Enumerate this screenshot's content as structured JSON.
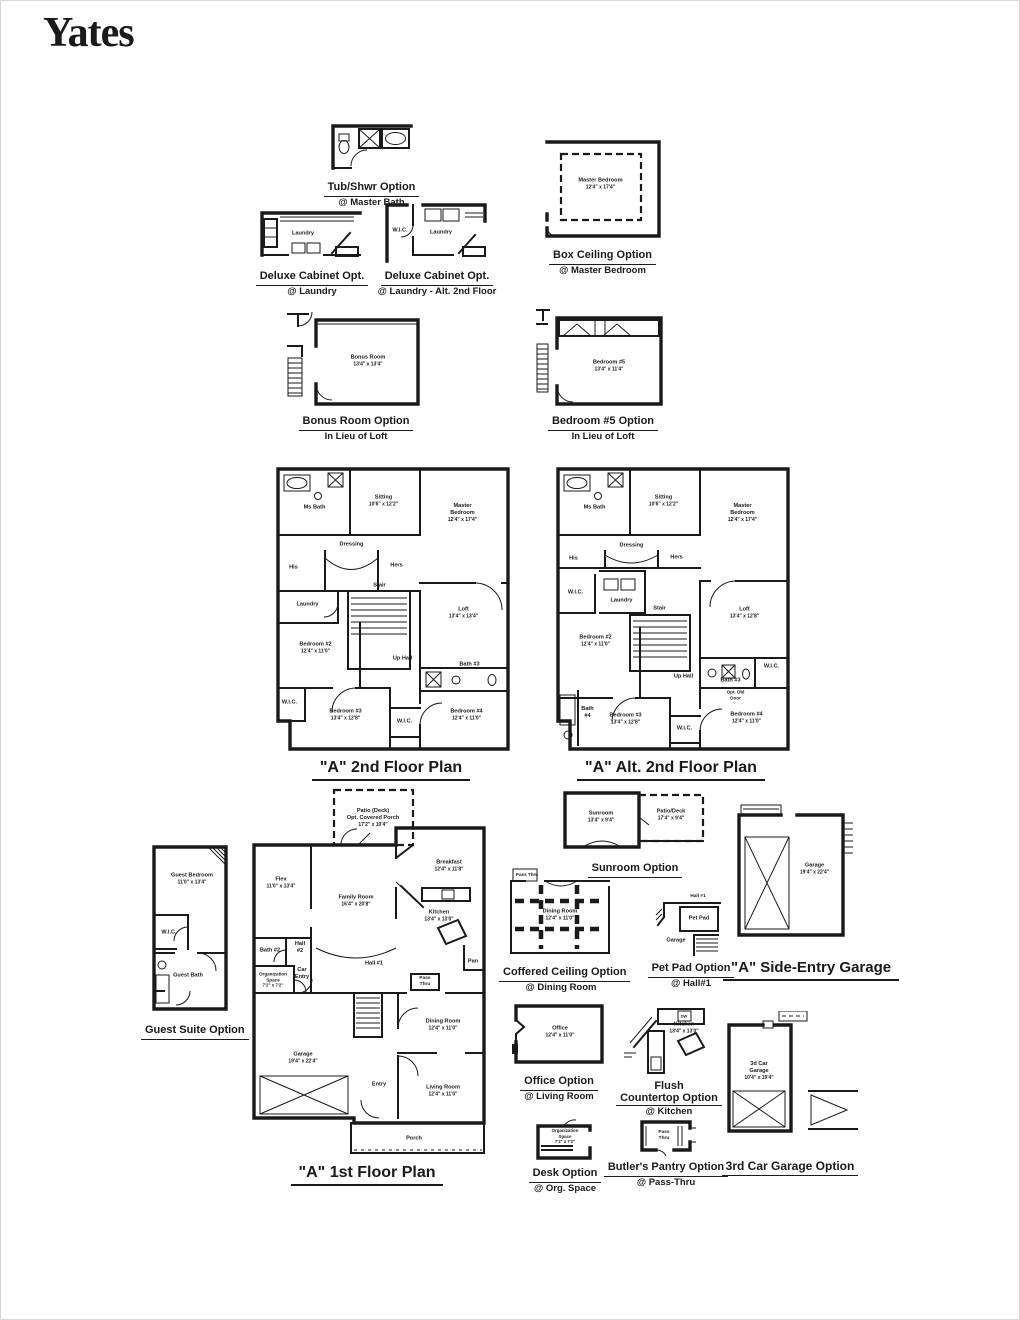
{
  "page": {
    "title": "Yates"
  },
  "options": {
    "tub_shwr": {
      "title": "Tub/Shwr Option",
      "subtitle": "@ Master Bath"
    },
    "deluxe1": {
      "title": "Deluxe Cabinet Opt.",
      "subtitle": "@ Laundry",
      "rooms": {
        "laundry": {
          "name": "Laundry"
        }
      }
    },
    "deluxe2": {
      "title": "Deluxe Cabinet Opt.",
      "subtitle": "@ Laundry - Alt. 2nd Floor",
      "rooms": {
        "laundry": {
          "name": "Laundry"
        },
        "wic": {
          "name": "W.I.C."
        }
      }
    },
    "box_ceiling": {
      "title": "Box Ceiling Option",
      "subtitle": "@ Master Bedroom",
      "rooms": {
        "master": {
          "name": "Master Bedroom",
          "dims": "12'4\" x 17'4\""
        }
      }
    },
    "bonus": {
      "title": "Bonus Room Option",
      "subtitle": "In Lieu of Loft",
      "rooms": {
        "bonus": {
          "name": "Bonus Room",
          "dims": "13'4\" x 13'4\""
        }
      }
    },
    "bedroom5": {
      "title": "Bedroom #5 Option",
      "subtitle": "In Lieu of Loft",
      "rooms": {
        "bed5": {
          "name": "Bedroom #5",
          "dims": "13'4\" x 11'4\""
        }
      }
    },
    "guest": {
      "title": "Guest Suite Option",
      "rooms": {
        "bedroom": {
          "name": "Guest Bedroom",
          "dims": "11'0\" x 13'4\""
        },
        "wic": {
          "name": "W.I.C."
        },
        "bath": {
          "name": "Guest Bath"
        }
      }
    },
    "sunroom": {
      "title": "Sunroom Option",
      "rooms": {
        "sunroom": {
          "name": "Sunroom",
          "dims": "13'4\" x 9'4\""
        },
        "patio": {
          "name": "Patio/Deck",
          "dims": "17'4\" x 9'4\""
        }
      }
    },
    "coffered": {
      "title": "Coffered Ceiling Option",
      "subtitle": "@ Dining Room",
      "rooms": {
        "dining": {
          "name": "Dining Room",
          "dims": "12'4\" x 11'0\""
        },
        "pass": {
          "name": "Pass Thru"
        }
      }
    },
    "petpad": {
      "title": "Pet Pad Option",
      "subtitle": "@ Hall#1",
      "rooms": {
        "hall": {
          "name": "Hall #1"
        },
        "pet": {
          "name": "Pet Pad"
        },
        "garage": {
          "name": "Garage"
        }
      }
    },
    "sidegarage": {
      "title": "\"A\" Side-Entry Garage",
      "rooms": {
        "garage": {
          "name": "Garage",
          "dims": "19'4\" x 22'4\""
        }
      }
    },
    "office": {
      "title": "Office Option",
      "subtitle": "@ Living Room",
      "rooms": {
        "office": {
          "name": "Office",
          "dims": "12'4\" x 11'0\""
        }
      }
    },
    "flush": {
      "title1": "Flush",
      "title2": "Countertop Option",
      "subtitle": "@ Kitchen",
      "rooms": {
        "kitchen": {
          "name": "Kitchen",
          "dims": "13'4\" x 13'0\""
        },
        "dw": {
          "name": "DW"
        }
      }
    },
    "desk": {
      "title": "Desk Option",
      "subtitle": "@ Org. Space",
      "rooms": {
        "org": {
          "name": "Organization",
          "name2": "Space",
          "dims": "7'2\" x 7'2\""
        }
      }
    },
    "butlers": {
      "title": "Butler's Pantry Option",
      "subtitle": "@ Pass-Thru",
      "rooms": {
        "pass": {
          "name": "Pass",
          "name2": "Thru"
        }
      }
    },
    "garage3": {
      "title": "3rd Car Garage Option",
      "rooms": {
        "garage": {
          "name": "3d Car",
          "name2": "Garage",
          "dims": "10'4\" x 19'4\""
        }
      }
    }
  },
  "plans": {
    "second": {
      "title": "\"A\" 2nd Floor Plan",
      "rooms": {
        "ms_bath": {
          "name": "Ms Bath"
        },
        "sitting": {
          "name": "Sitting",
          "dims": "10'6\" x 12'2\""
        },
        "master": {
          "name": "Master",
          "name2": "Bedroom",
          "dims": "12'4\" x 17'4\""
        },
        "dressing": {
          "name": "Dressing"
        },
        "his": {
          "name": "His"
        },
        "hers": {
          "name": "Hers"
        },
        "laundry": {
          "name": "Laundry"
        },
        "stair": {
          "name": "Stair"
        },
        "loft": {
          "name": "Loft",
          "dims": "13'4\" x 13'4\""
        },
        "bedroom2": {
          "name": "Bedroom #2",
          "dims": "12'4\" x 11'0\""
        },
        "uphall": {
          "name": "Up Hall"
        },
        "bath3": {
          "name": "Bath #3"
        },
        "wic_left": {
          "name": "W.I.C."
        },
        "bedroom3": {
          "name": "Bedroom #3",
          "dims": "13'4\" x 12'8\""
        },
        "wic_mid": {
          "name": "W.I.C."
        },
        "bedroom4": {
          "name": "Bedroom #4",
          "dims": "12'4\" x 11'0\""
        }
      }
    },
    "alt_second": {
      "title": "\"A\" Alt. 2nd Floor Plan",
      "rooms": {
        "ms_bath": {
          "name": "Ms Bath"
        },
        "sitting": {
          "name": "Sitting",
          "dims": "10'6\" x 12'2\""
        },
        "master": {
          "name": "Master",
          "name2": "Bedroom",
          "dims": "12'4\" x 17'4\""
        },
        "dressing": {
          "name": "Dressing"
        },
        "his": {
          "name": "His"
        },
        "hers": {
          "name": "Hers"
        },
        "wic_left": {
          "name": "W.I.C."
        },
        "laundry": {
          "name": "Laundry"
        },
        "stair": {
          "name": "Stair"
        },
        "loft": {
          "name": "Loft",
          "dims": "13'4\" x 12'8\""
        },
        "bedroom2": {
          "name": "Bedroom #2",
          "dims": "12'4\" x 11'0\""
        },
        "uphall": {
          "name": "Up Hall"
        },
        "bath3": {
          "name": "Bath #3"
        },
        "wic_right": {
          "name": "W.I.C."
        },
        "dbl_door": {
          "name": "Opt. Dbl",
          "name2": "Door"
        },
        "bath4": {
          "name": "Bath",
          "name2": "#4"
        },
        "bedroom3": {
          "name": "Bedroom #3",
          "dims": "13'4\" x 12'8\""
        },
        "wic_mid": {
          "name": "W.I.C."
        },
        "bedroom4": {
          "name": "Bedroom #4",
          "dims": "12'4\" x 11'0\""
        }
      }
    },
    "first": {
      "title": "\"A\" 1st Floor Plan",
      "rooms": {
        "patio": {
          "name": "Patio (Deck)",
          "name2": "Opt. Covered Porch",
          "dims": "17'2\" x 10'4\""
        },
        "flex": {
          "name": "Flex",
          "dims": "11'0\" x 13'4\""
        },
        "family": {
          "name": "Family Room",
          "dims": "16'4\" x 20'8\""
        },
        "breakfast": {
          "name": "Breakfast",
          "dims": "12'4\" x 11'8\""
        },
        "kitchen": {
          "name": "Kitchen",
          "dims": "13'4\" x 13'0\""
        },
        "bath2": {
          "name": "Bath #2"
        },
        "hall2": {
          "name": "Hall",
          "name2": "#2"
        },
        "car_entry": {
          "name": "Car",
          "name2": "Entry"
        },
        "org": {
          "name": "Organization",
          "name2": "Space",
          "dims": "7'2\" x 7'2\""
        },
        "hall1": {
          "name": "Hall #1"
        },
        "pass": {
          "name": "Pass",
          "name2": "Thru"
        },
        "pan": {
          "name": "Pan"
        },
        "garage": {
          "name": "Garage",
          "dims": "19'4\" x 22'4\""
        },
        "stair": {
          "name": ""
        },
        "dining": {
          "name": "Dining Room",
          "dims": "12'4\" x 11'0\""
        },
        "entry": {
          "name": "Entry"
        },
        "living": {
          "name": "Living Room",
          "dims": "12'4\" x 11'0\""
        },
        "porch": {
          "name": "Porch"
        }
      }
    }
  }
}
